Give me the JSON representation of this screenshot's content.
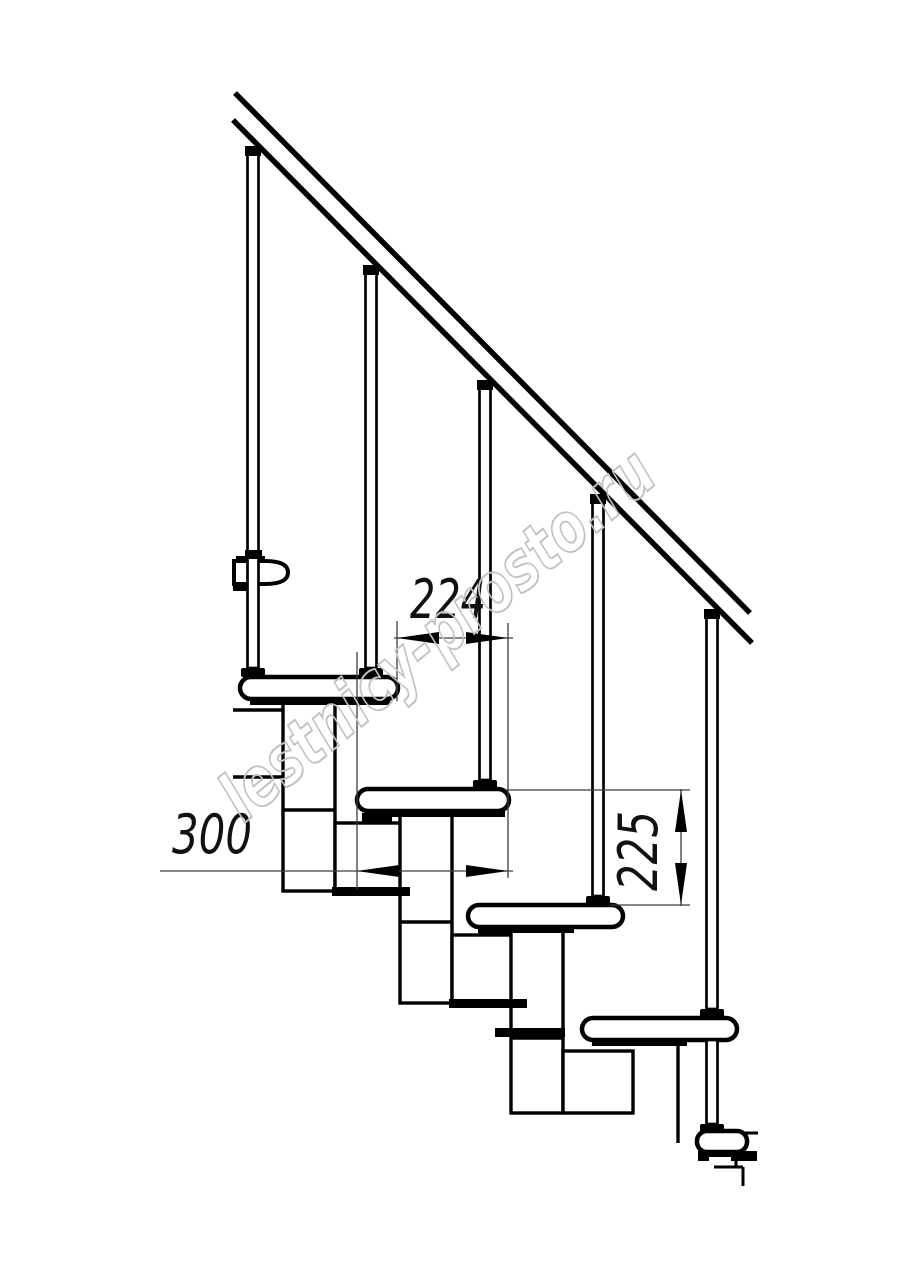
{
  "drawing": {
    "kind": "staircase side-view technical drawing",
    "colors": {
      "background": "#ffffff",
      "line": "#000000",
      "dim_line": "#3d3d3d",
      "watermark": "#bfc3c7"
    },
    "watermark": {
      "text": "lestnicy-prosto.ru"
    },
    "dimensions": {
      "going": {
        "value": "224",
        "orientation": "horizontal"
      },
      "tread_depth": {
        "value": "300",
        "orientation": "horizontal"
      },
      "riser": {
        "value": "225",
        "orientation": "vertical"
      }
    }
  }
}
